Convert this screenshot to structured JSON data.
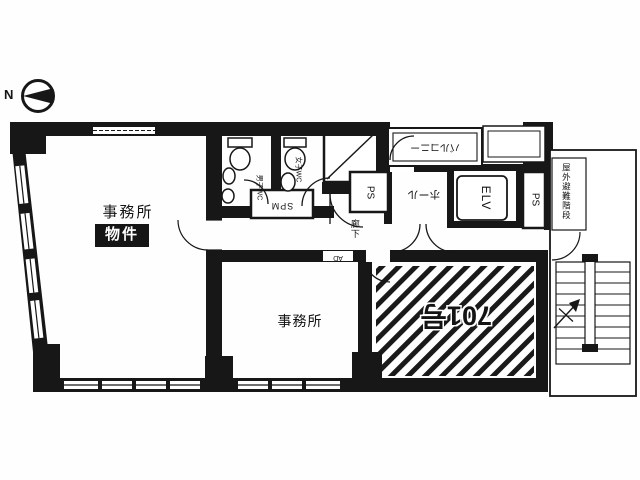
{
  "colors": {
    "wall": "#171717",
    "background": "#fefefe",
    "hatch": "#1a1a1a",
    "badge_bg": "#151515",
    "badge_text": "#ffffff"
  },
  "compass": {
    "label": "N"
  },
  "rooms": {
    "left_office": {
      "label": "事務所",
      "badge": "物件"
    },
    "middle_office": {
      "label": "事務所"
    },
    "unit_701": {
      "label": "701号"
    },
    "hall": {
      "label": "ホール"
    },
    "balcony": {
      "label": "バルコニー"
    },
    "corridor": {
      "label": "廊下"
    },
    "elevator": {
      "label": "ELV"
    },
    "ps_left": {
      "label": "PS"
    },
    "ps_right": {
      "label": "PS"
    },
    "ps_small": {
      "label": "SPM"
    },
    "wc_left": {
      "label": "男子WC"
    },
    "wc_right": {
      "label": "女子WC"
    },
    "air_duct": {
      "label": "AD"
    },
    "stairwell": {
      "label": "屋外避難階段"
    }
  }
}
